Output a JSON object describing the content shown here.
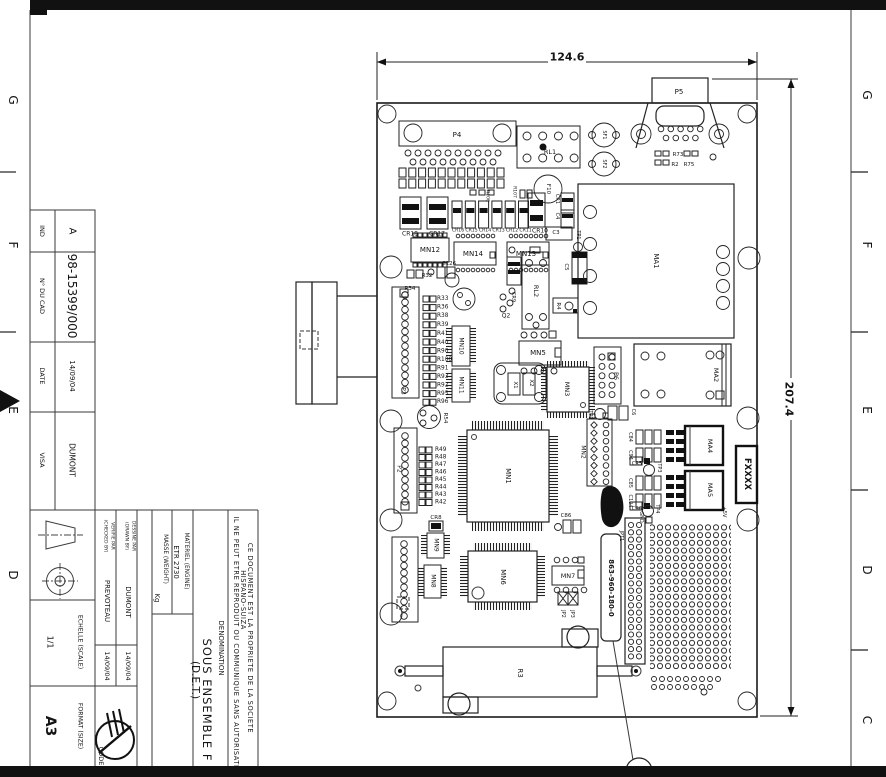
{
  "meta": {
    "kind": "engineering-drawing",
    "sheet": "A3 rotated 90deg",
    "content": "PCB sous-ensemble assembly drawing"
  },
  "frame": {
    "left_letters": [
      "G",
      "F",
      "E",
      "D"
    ],
    "right_letters": [
      "G",
      "F",
      "E",
      "D",
      "C"
    ]
  },
  "dimensions": {
    "board_width": "124.6",
    "board_height": "207.4"
  },
  "title_block": {
    "ind_label": "IND",
    "ind_value": "A",
    "cad_number_label": "N° DU CAD",
    "cad_number": "98-15399/000",
    "date_label": "DATE",
    "date_value": "14/09/04",
    "visa_label": "VISA",
    "visa_value": "DUMONT",
    "scale_label": "ECHELLE (SCALE)",
    "scale_value": "1/1",
    "format_label": "FORMAT (SIZE)",
    "format_value": "A3",
    "code_label": "CODE",
    "drawn_by_label_1": "DESSINE PAR",
    "drawn_by_label_2": "(DRAWN BY)",
    "drawn_by": "DUMONT",
    "drawn_date": "14/09/04",
    "checked_by_label_1": "VERIFIE PAR",
    "checked_by_label_2": "(CHECKED BY)",
    "checked_by": "PREVOTEAU",
    "checked_date": "14/09/04",
    "materiel_label": "MATERIEL (ENGINE)",
    "materiel_value": "ETR 2730",
    "masse_label": "MASSE (WEIGHT)",
    "masse_value": "Kg",
    "denomination_label": "DENOMINATION",
    "denomination": "SOUS ENSEMBLE F",
    "denomination_sub": "(D.E.T.)",
    "legal": [
      "CE DOCUMENT EST LA PROPRIETE DE LA SOCIETE",
      "HISPANO-SUIZA",
      "IL NE PEUT ETRE REPRODUIT OU COMMUNIQUE SANS AUTORISATI"
    ]
  },
  "board": {
    "part_label": "863-960-180-0",
    "masked_label": "FXXXX",
    "power_labels": [
      "+5V",
      "GND"
    ]
  },
  "labels": [
    {
      "t": "G",
      "x": 13,
      "y": 100,
      "r": 90,
      "s": 12,
      "n": "zone-letter-left-g"
    },
    {
      "t": "F",
      "x": 13,
      "y": 245,
      "r": 90,
      "s": 12,
      "n": "zone-letter-left-f"
    },
    {
      "t": "E",
      "x": 13,
      "y": 410,
      "r": 90,
      "s": 12,
      "n": "zone-letter-left-e"
    },
    {
      "t": "D",
      "x": 13,
      "y": 575,
      "r": 90,
      "s": 12,
      "n": "zone-letter-left-d"
    },
    {
      "t": "G",
      "x": 867,
      "y": 95,
      "r": 90,
      "s": 12,
      "n": "zone-letter-right-g"
    },
    {
      "t": "F",
      "x": 867,
      "y": 245,
      "r": 90,
      "s": 12,
      "n": "zone-letter-right-f"
    },
    {
      "t": "E",
      "x": 867,
      "y": 410,
      "r": 90,
      "s": 12,
      "n": "zone-letter-right-e"
    },
    {
      "t": "D",
      "x": 867,
      "y": 570,
      "r": 90,
      "s": 12,
      "n": "zone-letter-right-d"
    },
    {
      "t": "C",
      "x": 867,
      "y": 720,
      "r": 90,
      "s": 12,
      "n": "zone-letter-right-c"
    },
    {
      "t": "124.6",
      "x": 567,
      "y": 57,
      "r": 0,
      "s": 11,
      "w": 1,
      "n": "dim-width"
    },
    {
      "t": "207.4",
      "x": 789,
      "y": 399,
      "r": 90,
      "s": 11,
      "w": 1,
      "n": "dim-height"
    },
    {
      "t": "IND",
      "x": 42,
      "y": 231,
      "r": 90,
      "s": 6.5
    },
    {
      "t": "A",
      "x": 72,
      "y": 231,
      "r": 90,
      "s": 10,
      "n": "revision-index"
    },
    {
      "t": "N° DU CAD",
      "x": 42,
      "y": 296,
      "r": 90,
      "s": 6.5
    },
    {
      "t": "98-15399/000",
      "x": 72,
      "y": 296,
      "r": 90,
      "s": 12,
      "n": "cad-number"
    },
    {
      "t": "DATE",
      "x": 42,
      "y": 376,
      "r": 90,
      "s": 6.5
    },
    {
      "t": "14/09/04",
      "x": 72,
      "y": 376,
      "r": 90,
      "s": 7
    },
    {
      "t": "VISA",
      "x": 42,
      "y": 460,
      "r": 90,
      "s": 6.5
    },
    {
      "t": "DUMONT",
      "x": 72,
      "y": 460,
      "r": 90,
      "s": 7.5
    },
    {
      "t": "1/1",
      "x": 50,
      "y": 642,
      "r": 90,
      "s": 8,
      "n": "scale-value"
    },
    {
      "t": "ECHELLE (SCALE)",
      "x": 80,
      "y": 642,
      "r": 90,
      "s": 6.2
    },
    {
      "t": "A3",
      "x": 50,
      "y": 726,
      "r": 90,
      "s": 14,
      "w": 1,
      "n": "format-value"
    },
    {
      "t": "FORMAT (SIZE)",
      "x": 80,
      "y": 726,
      "r": 90,
      "s": 6.2
    },
    {
      "t": "CODE",
      "x": 101,
      "y": 756,
      "r": 90,
      "s": 6.5
    },
    {
      "t": "VERIFIE PAR",
      "x": 112,
      "y": 536,
      "r": 90,
      "s": 4.6
    },
    {
      "t": "(CHECKED BY)",
      "x": 105,
      "y": 536,
      "r": 90,
      "s": 4.6
    },
    {
      "t": "PREVOTEAU",
      "x": 107,
      "y": 601,
      "r": 90,
      "s": 7
    },
    {
      "t": "14/09/04",
      "x": 107,
      "y": 666,
      "r": 90,
      "s": 6.5
    },
    {
      "t": "DESSINE PAR",
      "x": 133,
      "y": 536,
      "r": 90,
      "s": 4.6
    },
    {
      "t": "(DRAWN BY)",
      "x": 126,
      "y": 536,
      "r": 90,
      "s": 4.6
    },
    {
      "t": "DUMONT",
      "x": 128,
      "y": 602,
      "r": 90,
      "s": 7
    },
    {
      "t": "14/09/04",
      "x": 128,
      "y": 666,
      "r": 90,
      "s": 6.5
    },
    {
      "t": "MASSE (WEIGHT)",
      "x": 165,
      "y": 559,
      "r": 90,
      "s": 5.8
    },
    {
      "t": "Kg",
      "x": 157,
      "y": 598,
      "r": 90,
      "s": 7
    },
    {
      "t": "MATERIEL (ENGINE)",
      "x": 186,
      "y": 561,
      "r": 90,
      "s": 5.8
    },
    {
      "t": "ETR 2730",
      "x": 176,
      "y": 562,
      "r": 90,
      "s": 7
    },
    {
      "t": "DENOMINATION",
      "x": 221,
      "y": 648,
      "r": 90,
      "s": 7
    },
    {
      "t": "SOUS ENSEMBLE F",
      "x": 207,
      "y": 700,
      "r": 90,
      "s": 11.5,
      "ls": 1,
      "n": "denomination"
    },
    {
      "t": "(D.E.T.)",
      "x": 195,
      "y": 680,
      "r": 90,
      "s": 10.5
    },
    {
      "t": "CE DOCUMENT EST LA PROPRIETE DE LA SOCIETE",
      "x": 250,
      "y": 638,
      "r": 90,
      "s": 6.6,
      "ls": 0.6
    },
    {
      "t": "HISPANO-SUIZA",
      "x": 243,
      "y": 600,
      "r": 90,
      "s": 6.6,
      "ls": 0.6
    },
    {
      "t": "IL NE PEUT ETRE REPRODUIT OU COMMUNIQUE SANS AUTORISATI",
      "x": 236,
      "y": 642,
      "r": 90,
      "s": 6.6,
      "ls": 0.6
    },
    {
      "t": "P4",
      "x": 457,
      "y": 135,
      "r": 0,
      "s": 7
    },
    {
      "t": "RL1",
      "x": 550,
      "y": 152,
      "r": 0,
      "s": 6.5
    },
    {
      "t": "P5",
      "x": 679,
      "y": 92,
      "r": 0,
      "s": 7
    },
    {
      "t": "SF1",
      "x": 604,
      "y": 135,
      "r": 90,
      "s": 5
    },
    {
      "t": "SF2",
      "x": 604,
      "y": 164,
      "r": 90,
      "s": 5
    },
    {
      "t": "R73",
      "x": 678,
      "y": 155,
      "r": 0,
      "s": 5.5
    },
    {
      "t": "R2",
      "x": 675,
      "y": 165,
      "r": 0,
      "s": 5.5
    },
    {
      "t": "R75",
      "x": 689,
      "y": 165,
      "r": 0,
      "s": 5.5
    },
    {
      "t": "F10",
      "x": 548,
      "y": 189,
      "r": 90,
      "s": 5.5
    },
    {
      "t": "R106",
      "x": 487,
      "y": 196,
      "r": 90,
      "s": 4.5
    },
    {
      "t": "R107",
      "x": 514,
      "y": 192,
      "r": 90,
      "s": 4.5
    },
    {
      "t": "CR18",
      "x": 410,
      "y": 234,
      "r": 0,
      "s": 6
    },
    {
      "t": "CR17",
      "x": 437,
      "y": 234,
      "r": 0,
      "s": 6
    },
    {
      "t": "CR16",
      "x": 458,
      "y": 231,
      "r": 0,
      "s": 4.6
    },
    {
      "t": "CR15",
      "x": 471.5,
      "y": 231,
      "r": 0,
      "s": 4.6
    },
    {
      "t": "CR14",
      "x": 485,
      "y": 231,
      "r": 0,
      "s": 4.6
    },
    {
      "t": "CR13",
      "x": 498.5,
      "y": 231,
      "r": 0,
      "s": 4.6
    },
    {
      "t": "CR12",
      "x": 512,
      "y": 231,
      "r": 0,
      "s": 4.6
    },
    {
      "t": "CR11",
      "x": 525.5,
      "y": 231,
      "r": 0,
      "s": 4.6
    },
    {
      "t": "CR10",
      "x": 540,
      "y": 231,
      "r": 0,
      "s": 6
    },
    {
      "t": "MN12",
      "x": 430,
      "y": 250,
      "r": 0,
      "s": 7
    },
    {
      "t": "MN14",
      "x": 473,
      "y": 254,
      "r": 0,
      "s": 7
    },
    {
      "t": "MN13",
      "x": 526,
      "y": 254,
      "r": 0,
      "s": 7
    },
    {
      "t": "C126",
      "x": 449,
      "y": 264,
      "r": 0,
      "s": 5.5
    },
    {
      "t": "R32",
      "x": 427,
      "y": 276,
      "r": 0,
      "s": 5.5
    },
    {
      "t": "R34",
      "x": 410,
      "y": 289,
      "r": 0,
      "s": 5.5
    },
    {
      "t": "CR1",
      "x": 557,
      "y": 199,
      "r": 90,
      "s": 5
    },
    {
      "t": "C4",
      "x": 557,
      "y": 216,
      "r": 90,
      "s": 5
    },
    {
      "t": "C3",
      "x": 556,
      "y": 233,
      "r": 0,
      "s": 5.5
    },
    {
      "t": "TP1",
      "x": 578,
      "y": 235,
      "r": 90,
      "s": 5
    },
    {
      "t": "C5",
      "x": 566,
      "y": 267,
      "r": 90,
      "s": 5.5
    },
    {
      "t": "MA1",
      "x": 656,
      "y": 261,
      "r": 90,
      "s": 7
    },
    {
      "t": "R33",
      "x": 437,
      "y": 299,
      "r": 0,
      "s": 5.8,
      "a": "s"
    },
    {
      "t": "R36",
      "x": 437,
      "y": 307.5,
      "r": 0,
      "s": 5.8,
      "a": "s"
    },
    {
      "t": "R38",
      "x": 437,
      "y": 316,
      "r": 0,
      "s": 5.8,
      "a": "s"
    },
    {
      "t": "R39",
      "x": 437,
      "y": 325,
      "r": 0,
      "s": 5.8,
      "a": "s"
    },
    {
      "t": "R41",
      "x": 437,
      "y": 334,
      "r": 0,
      "s": 5.8,
      "a": "s"
    },
    {
      "t": "R40",
      "x": 437,
      "y": 343,
      "r": 0,
      "s": 5.8,
      "a": "s"
    },
    {
      "t": "R90",
      "x": 437,
      "y": 351.5,
      "r": 0,
      "s": 5.8,
      "a": "s"
    },
    {
      "t": "R100",
      "x": 437,
      "y": 360,
      "r": 0,
      "s": 5.8,
      "a": "s"
    },
    {
      "t": "R91",
      "x": 437,
      "y": 368.5,
      "r": 0,
      "s": 5.8,
      "a": "s"
    },
    {
      "t": "R93",
      "x": 437,
      "y": 377,
      "r": 0,
      "s": 5.8,
      "a": "s"
    },
    {
      "t": "R92",
      "x": 437,
      "y": 385.5,
      "r": 0,
      "s": 5.8,
      "a": "s"
    },
    {
      "t": "R95",
      "x": 437,
      "y": 394,
      "r": 0,
      "s": 5.8,
      "a": "s"
    },
    {
      "t": "R96",
      "x": 437,
      "y": 402,
      "r": 0,
      "s": 5.8,
      "a": "s"
    },
    {
      "t": "P3",
      "x": 403,
      "y": 391,
      "r": 90,
      "s": 6
    },
    {
      "t": "MN10",
      "x": 461,
      "y": 346,
      "r": 90,
      "s": 6
    },
    {
      "t": "MN11",
      "x": 461,
      "y": 385,
      "r": 90,
      "s": 6
    },
    {
      "t": "Q2",
      "x": 506,
      "y": 316,
      "r": 0,
      "s": 6
    },
    {
      "t": "CR9",
      "x": 513,
      "y": 297,
      "r": 90,
      "s": 5
    },
    {
      "t": "RL2",
      "x": 536,
      "y": 291,
      "r": 90,
      "s": 6.5
    },
    {
      "t": "R4",
      "x": 558,
      "y": 306,
      "r": 90,
      "s": 5.5
    },
    {
      "t": "MN5",
      "x": 538,
      "y": 353,
      "r": 0,
      "s": 7
    },
    {
      "t": "X1",
      "x": 515,
      "y": 385,
      "r": 90,
      "s": 5.5
    },
    {
      "t": "X2",
      "x": 531,
      "y": 383,
      "r": 90,
      "s": 5.5
    },
    {
      "t": "MN3",
      "x": 567,
      "y": 389,
      "r": 90,
      "s": 6.5
    },
    {
      "t": "P6",
      "x": 616,
      "y": 376,
      "r": 90,
      "s": 6.5
    },
    {
      "t": "MA2",
      "x": 716,
      "y": 375,
      "r": 90,
      "s": 6.5
    },
    {
      "t": "TP2",
      "x": 590,
      "y": 415,
      "r": 90,
      "s": 5
    },
    {
      "t": "C6",
      "x": 633,
      "y": 412,
      "r": 90,
      "s": 5
    },
    {
      "t": "MN2",
      "x": 583,
      "y": 452,
      "r": 90,
      "s": 6
    },
    {
      "t": "C84",
      "x": 630,
      "y": 437,
      "r": 90,
      "s": 5
    },
    {
      "t": "C94",
      "x": 630,
      "y": 455,
      "r": 90,
      "s": 5
    },
    {
      "t": "CR5",
      "x": 637,
      "y": 464,
      "r": 0,
      "s": 5
    },
    {
      "t": "TP3",
      "x": 659,
      "y": 468,
      "r": 90,
      "s": 5
    },
    {
      "t": "C85",
      "x": 630,
      "y": 483,
      "r": 90,
      "s": 5
    },
    {
      "t": "C104",
      "x": 630,
      "y": 501,
      "r": 90,
      "s": 5
    },
    {
      "t": "CR6",
      "x": 637,
      "y": 509,
      "r": 0,
      "s": 5
    },
    {
      "t": "TP4",
      "x": 657,
      "y": 509,
      "r": 90,
      "s": 5
    },
    {
      "t": "GND",
      "x": 641,
      "y": 517,
      "r": 90,
      "s": 5
    },
    {
      "t": "MA4",
      "x": 710,
      "y": 446,
      "r": 90,
      "s": 6.5
    },
    {
      "t": "MA5",
      "x": 710,
      "y": 490,
      "r": 90,
      "s": 6.5
    },
    {
      "t": "FXXXX",
      "x": 747,
      "y": 474,
      "r": 90,
      "s": 8.5,
      "w": 1,
      "n": "masked-brand-label"
    },
    {
      "t": "+5V",
      "x": 724,
      "y": 512,
      "r": 90,
      "s": 5
    },
    {
      "t": "JPT1",
      "x": 621,
      "y": 536,
      "r": 90,
      "s": 5
    },
    {
      "t": "863-960-180-0",
      "x": 611,
      "y": 588,
      "r": 90,
      "s": 7,
      "w": 1,
      "n": "board-part-number"
    },
    {
      "t": "MN1",
      "x": 508,
      "y": 476,
      "r": 90,
      "s": 7
    },
    {
      "t": "C86",
      "x": 566,
      "y": 516,
      "r": 0,
      "s": 5.5
    },
    {
      "t": "R54",
      "x": 445,
      "y": 418,
      "r": 90,
      "s": 5.5
    },
    {
      "t": "P2",
      "x": 399,
      "y": 469,
      "r": 90,
      "s": 6
    },
    {
      "t": "R49",
      "x": 435,
      "y": 450,
      "r": 0,
      "s": 5.8,
      "a": "s"
    },
    {
      "t": "R48",
      "x": 435,
      "y": 457.5,
      "r": 0,
      "s": 5.8,
      "a": "s"
    },
    {
      "t": "R47",
      "x": 435,
      "y": 465,
      "r": 0,
      "s": 5.8,
      "a": "s"
    },
    {
      "t": "R46",
      "x": 435,
      "y": 472.5,
      "r": 0,
      "s": 5.8,
      "a": "s"
    },
    {
      "t": "R45",
      "x": 435,
      "y": 480,
      "r": 0,
      "s": 5.8,
      "a": "s"
    },
    {
      "t": "R44",
      "x": 435,
      "y": 487.5,
      "r": 0,
      "s": 5.8,
      "a": "s"
    },
    {
      "t": "R43",
      "x": 435,
      "y": 495,
      "r": 0,
      "s": 5.8,
      "a": "s"
    },
    {
      "t": "R42",
      "x": 435,
      "y": 502.5,
      "r": 0,
      "s": 5.8,
      "a": "s"
    },
    {
      "t": "CR8",
      "x": 436,
      "y": 518,
      "r": 0,
      "s": 5.5
    },
    {
      "t": "MN9",
      "x": 436,
      "y": 545,
      "r": 90,
      "s": 6
    },
    {
      "t": "MN8",
      "x": 433,
      "y": 581,
      "r": 90,
      "s": 6
    },
    {
      "t": "MN6",
      "x": 503,
      "y": 577,
      "r": 90,
      "s": 7
    },
    {
      "t": "MN7",
      "x": 568,
      "y": 576,
      "r": 0,
      "s": 6.5
    },
    {
      "t": "JP2",
      "x": 563,
      "y": 614,
      "r": 90,
      "s": 5
    },
    {
      "t": "JP3",
      "x": 572,
      "y": 614,
      "r": 90,
      "s": 5
    },
    {
      "t": "R3",
      "x": 520,
      "y": 673,
      "r": 90,
      "s": 7
    }
  ]
}
